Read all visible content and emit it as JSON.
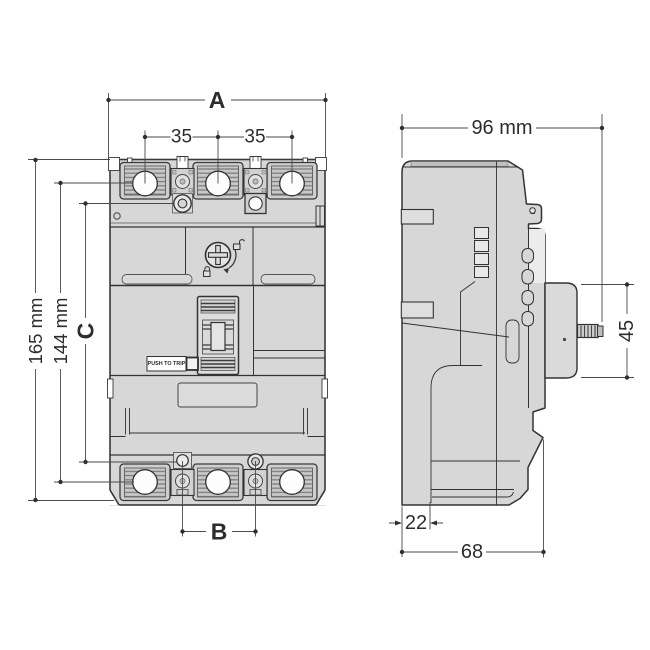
{
  "dims": {
    "a": "A",
    "b": "B",
    "c": "C",
    "pitch_left": "35",
    "pitch_right": "35",
    "height_total": "165 mm",
    "height_inner": "144 mm",
    "depth_total": "96 mm",
    "handle_frame_height": "45",
    "base_offset": "22",
    "base_depth": "68"
  },
  "labels": {
    "push_to_trip": "PUSH TO TRIP"
  },
  "colors": {
    "body": "#d7d7d7",
    "outline": "#3a3a3a",
    "dimension_line": "#4a4a4a",
    "text": "#2d2d2d",
    "background": "#ffffff"
  }
}
